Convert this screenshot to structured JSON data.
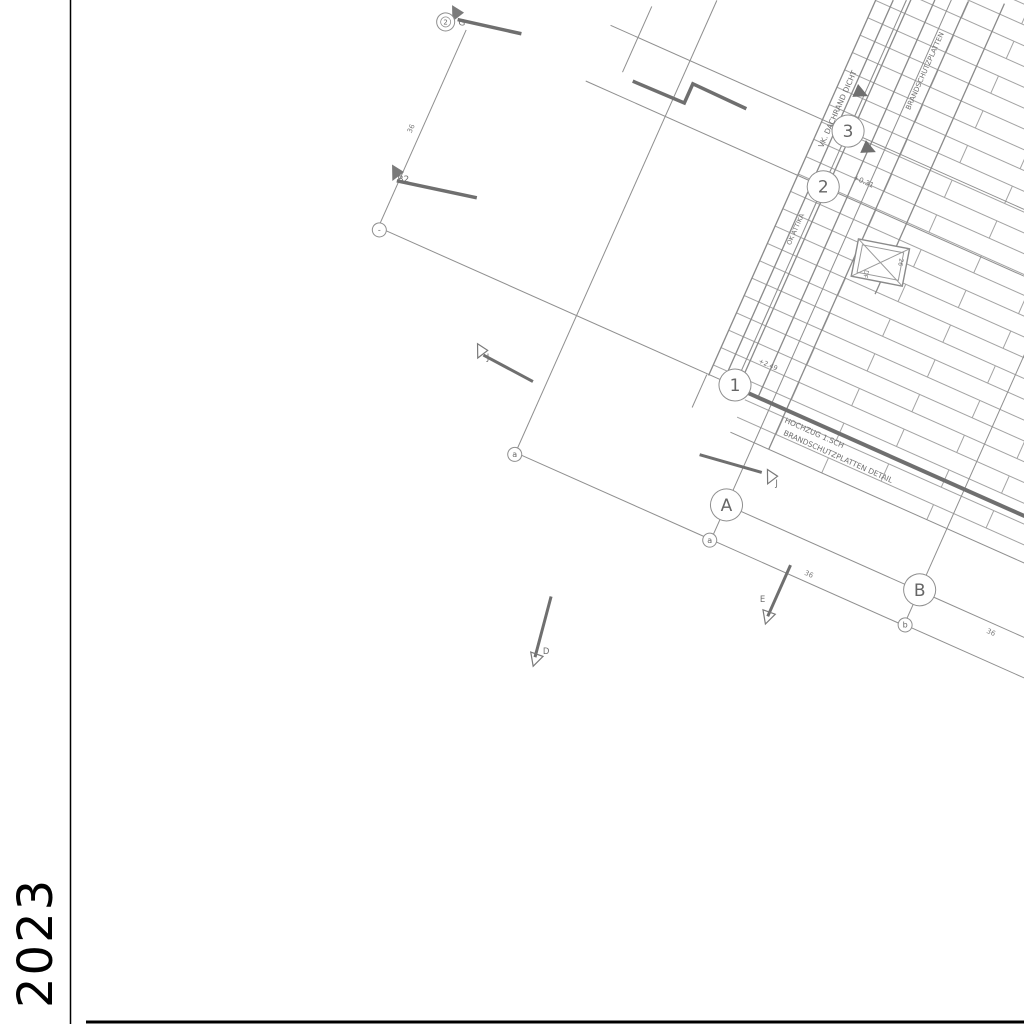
{
  "sheet": {
    "year_label": "2023"
  },
  "colors": {
    "grid_line": "#8f8f8f",
    "thick_line": "#6f6f6f",
    "text": "#6f6f6f",
    "frame": "#000000"
  },
  "axes": {
    "majors": {
      "one": {
        "label": "1"
      },
      "two": {
        "label": "2"
      },
      "three": {
        "label": "3"
      },
      "a": {
        "label": "A"
      },
      "b": {
        "label": "B"
      }
    },
    "minors": {
      "left_end": {
        "label": "a"
      },
      "under_a": {
        "label": "a"
      },
      "under_b": {
        "label": "b"
      },
      "line1_end": {
        "label": "-"
      },
      "top": {
        "label": "2"
      }
    }
  },
  "section_markers": {
    "b2": {
      "label": "B2"
    },
    "g": {
      "label": "G"
    },
    "j_upper": {
      "label": "J"
    },
    "j_lower": {
      "label": "J"
    },
    "d": {
      "label": "D"
    },
    "e": {
      "label": "E"
    }
  },
  "annotations": {
    "edge_note": "VK. DACHRAND DICHT",
    "hochzug_note_line1": "HOCHZUG 1.SCH",
    "hochzug_note_line2": "BRANDSCHUTZPLATTEN DETAIL",
    "layer_note": "BRANDSCHUTZPLATTEN",
    "attika_note": "OK ATTIKA",
    "level_1": "+0.31",
    "level_2": "+2.49",
    "skylight_label": "DF",
    "skylight_dim": "26",
    "dims": {
      "d1": "36",
      "d2": "36",
      "d3": "36"
    }
  }
}
